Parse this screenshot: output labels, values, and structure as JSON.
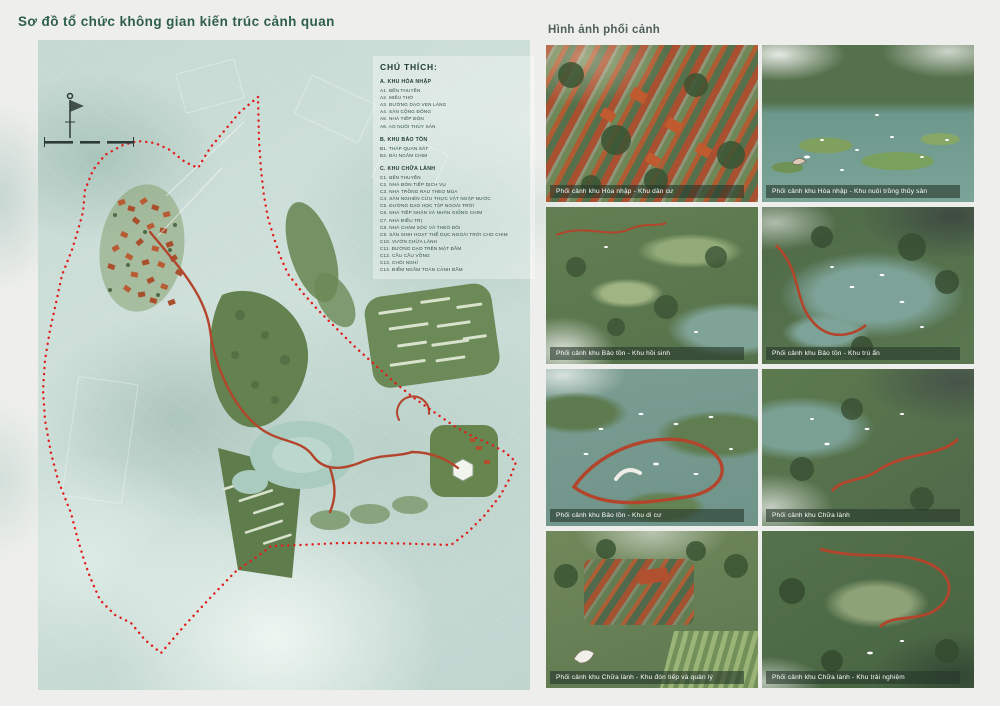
{
  "board": {
    "left_title": "Sơ đồ tổ chức không gian kiến trúc cảnh quan",
    "right_title": "Hình ảnh phối cảnh"
  },
  "legend": {
    "title": "CHÚ THÍCH:",
    "sections": [
      {
        "header": "A. KHU HÒA NHẬP",
        "items": [
          "A1. BẾN THUYỀN",
          "A2. MIẾU THỜ",
          "A3. ĐƯỜNG DẠO VEN LÀNG",
          "A4. SÂN CỘNG ĐỒNG",
          "A5. NHÀ TIẾP ĐÓN",
          "A6. AO NUÔI THỦY SẢN"
        ]
      },
      {
        "header": "B. KHU BẢO TỒN",
        "items": [
          "B1. THÁP QUAN SÁT",
          "B2. ĐÀI NGẮM CHIM"
        ]
      },
      {
        "header": "C. KHU CHỮA LÀNH",
        "items": [
          "C1. BẾN THUYỀN",
          "C2. NHÀ ĐÓN TIẾP DỊCH VỤ",
          "C3. NHÀ TRỒNG RAU THEO MÙA",
          "C4. SÂN NGHIÊN CỨU THỰC VẬT NGẬP NƯỚC",
          "C5. ĐƯỜNG DẠO HỌC TẬP NGOÀI TRỜI",
          "C6. NHÀ TIẾP NHẬN VÀ NHÂN GIỐNG CHIM",
          "C7. NHÀ ĐIỀU TRỊ",
          "C8. NHÀ CHĂM SÓC VÀ THEO DÕI",
          "C9. SÂN SINH HOẠT THỂ DỤC NGOÀI TRỜI CHO CHIM",
          "C10. VƯỜN CHỮA LÀNH",
          "C11. ĐƯỜNG DẠO TRÊN MẶT ĐẦM",
          "C12. CẦU CẦU VỒNG",
          "C13. CHÒI NGHỈ",
          "C14. ĐIỂM NGẮM TOÀN CẢNH ĐẦM"
        ]
      }
    ]
  },
  "renders": [
    {
      "caption": "Phối cảnh khu Hòa nhập - Khu dân cư"
    },
    {
      "caption": "Phối cảnh khu Hòa nhập - Khu nuôi trồng thủy sản"
    },
    {
      "caption": "Phối cảnh khu Bảo tồn - Khu hồi sinh"
    },
    {
      "caption": "Phối cảnh khu Bảo tồn - Khu trú ẩn"
    },
    {
      "caption": "Phối cảnh khu Bảo tồn - Khu di cư"
    },
    {
      "caption": "Phối cảnh khu Chữa lành"
    },
    {
      "caption": "Phối cảnh khu Chữa lành - Khu đón tiếp và quản lý"
    },
    {
      "caption": "Phối cảnh khu Chữa lành - Khu trải nghiệm"
    }
  ],
  "colors": {
    "title_green": "#2f5f4b",
    "boundary_red": "#e01e1e",
    "path_red": "#b2452c",
    "map_wash_teal": "#cddfd8",
    "caption_bar": "rgba(38,56,44,0.62)",
    "caption_text": "#ffffff"
  }
}
